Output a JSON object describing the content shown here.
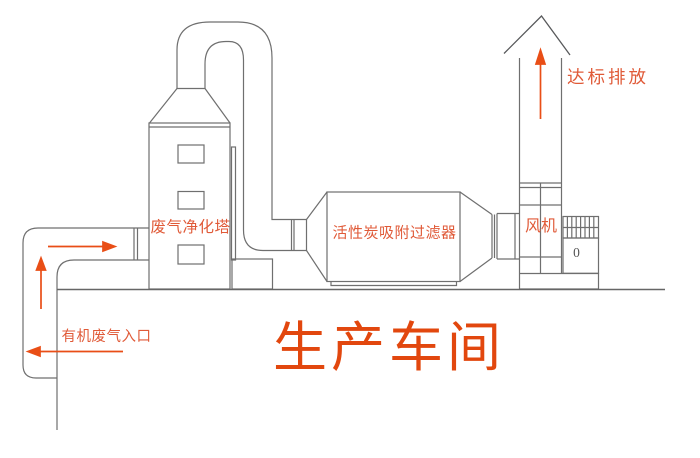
{
  "colors": {
    "background": "#ffffff",
    "line": "#6f6f6f",
    "line_dark": "#58595b",
    "ground": "#666666",
    "arrow": "#e94e16",
    "label": "#e05a38",
    "workshop_label": "#e2470e",
    "motor_mark": "#555555"
  },
  "equipment": {
    "tower": {
      "label": "废气净化塔"
    },
    "filter": {
      "label": "活性炭吸附过滤器"
    },
    "fan": {
      "label": "风机",
      "motor_mark": "0"
    },
    "stack": {
      "label": "达标排放"
    },
    "inlet": {
      "label": "有机废气入口"
    },
    "workshop": {
      "label": "生产车间"
    }
  },
  "flow_arrows": [
    {
      "name": "inlet-duct-up",
      "direction": "up"
    },
    {
      "name": "inlet-duct-right",
      "direction": "right"
    },
    {
      "name": "workshop-inlet",
      "direction": "left"
    },
    {
      "name": "stack-exhaust",
      "direction": "up"
    }
  ]
}
